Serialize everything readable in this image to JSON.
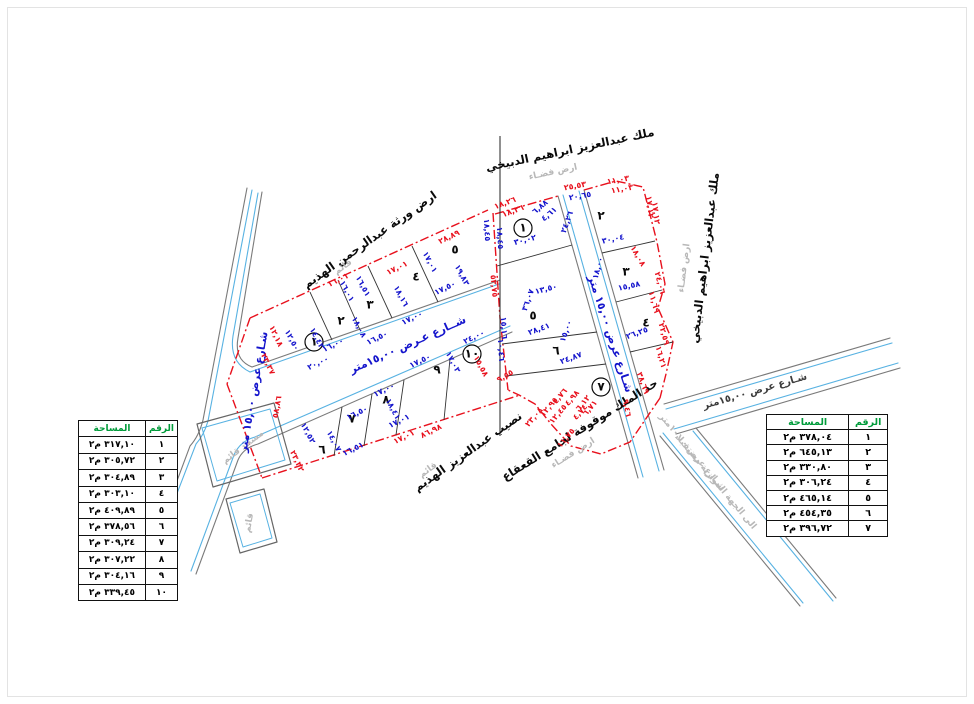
{
  "tables": {
    "left": {
      "headers": {
        "number": "الرقم",
        "area": "المساحة"
      },
      "unit": "م٢",
      "rows": [
        {
          "no": "١",
          "area": "٣١٧,١٠"
        },
        {
          "no": "٢",
          "area": "٣٠٥,٧٢"
        },
        {
          "no": "٣",
          "area": "٣٠٤,٨٩"
        },
        {
          "no": "٤",
          "area": "٣٠٣,١٠"
        },
        {
          "no": "٥",
          "area": "٤٠٩,٨٩"
        },
        {
          "no": "٦",
          "area": "٣٧٨,٥٦"
        },
        {
          "no": "٧",
          "area": "٣٠٩,٢٤"
        },
        {
          "no": "٨",
          "area": "٣٠٧,٢٢"
        },
        {
          "no": "٩",
          "area": "٣٠٤,١٦"
        },
        {
          "no": "١٠",
          "area": "٣٣٩,٤٥"
        }
      ]
    },
    "right": {
      "headers": {
        "number": "الرقم",
        "area": "المساحة"
      },
      "unit": "م٢",
      "rows": [
        {
          "no": "١",
          "area": "٣٧٨,٠٤"
        },
        {
          "no": "٢",
          "area": "٦٤٥,١٣"
        },
        {
          "no": "٣",
          "area": "٣٣٠,٨٠"
        },
        {
          "no": "٤",
          "area": "٣٠٦,٢٤"
        },
        {
          "no": "٥",
          "area": "٤٦٥,١٤"
        },
        {
          "no": "٦",
          "area": "٤٥٤,٣٥"
        },
        {
          "no": "٧",
          "area": "٣٩٦,٧٢"
        }
      ]
    }
  },
  "drawing": {
    "colors": {
      "dimension_red": "#e8111d",
      "dimension_blue": "#1414cc",
      "street_blue": "#58b2e2",
      "header_green": "#009b3a"
    },
    "labels": [
      {
        "t": "ملك عبدالعزيز ابراهيم الدبيخي",
        "x": 570,
        "y": 150,
        "r": -12,
        "c": "ow",
        "n": "owner-label-top"
      },
      {
        "t": "ارض فضـاء",
        "x": 553,
        "y": 172,
        "r": -12,
        "c": "mu",
        "n": "vacant-land-note"
      },
      {
        "t": "ملك عبدالعزيز ابراهيم الدبيخي",
        "x": 705,
        "y": 258,
        "r": -83,
        "c": "ow",
        "n": "owner-label-right"
      },
      {
        "t": "ارض فضـاء",
        "x": 684,
        "y": 268,
        "r": -83,
        "c": "mu",
        "n": "vacant-land-note"
      },
      {
        "t": "ارض ورثة عبدالرحمن الهذيم",
        "x": 370,
        "y": 240,
        "r": -35,
        "c": "ow",
        "n": "owner-label-top-left"
      },
      {
        "t": "قائم",
        "x": 343,
        "y": 267,
        "r": -35,
        "c": "mu",
        "n": "existing-note"
      },
      {
        "t": "نصيب عبدالعزيز الهذيم",
        "x": 468,
        "y": 452,
        "r": -35,
        "c": "ow",
        "n": "owner-label-bottom"
      },
      {
        "t": "قائم",
        "x": 428,
        "y": 470,
        "r": -35,
        "c": "mu",
        "n": "existing-note"
      },
      {
        "t": "حد الملك موقوفة لجامع القعقاع",
        "x": 580,
        "y": 430,
        "r": -32,
        "c": "ow",
        "n": "boundary-note-mosque-endowment"
      },
      {
        "t": "ارض فضـاء",
        "x": 573,
        "y": 453,
        "r": -32,
        "c": "mu",
        "n": "vacant-land-note"
      },
      {
        "t": "مسجد قائم",
        "x": 243,
        "y": 447,
        "r": -37,
        "c": "mu",
        "n": "existing-mosque-note"
      },
      {
        "t": "قائم",
        "x": 249,
        "y": 523,
        "r": -80,
        "c": "mu",
        "n": "existing-note"
      },
      {
        "t": "شــارع عـرض ١٥,٠٠متر",
        "x": 408,
        "y": 345,
        "r": -24,
        "c": "st",
        "n": "street-label-central"
      },
      {
        "t": "شـارع عرض ١٥,٠٠ متر",
        "x": 254,
        "y": 392,
        "r": -80,
        "c": "st",
        "n": "street-label-left"
      },
      {
        "t": "شـارع عرض ١٥,٠٠ متر",
        "x": 610,
        "y": 334,
        "r": 72,
        "c": "st",
        "n": "street-label-right-block"
      },
      {
        "t": "شـارع عرض ١٥,٠٠متر",
        "x": 755,
        "y": 391,
        "r": -16,
        "c": "sd",
        "n": "street-label-far-right"
      },
      {
        "t": "شـارع عرض ١٠,٠٠متر",
        "x": 692,
        "y": 452,
        "r": 50,
        "c": "mu",
        "n": "future-street-label"
      },
      {
        "t": "الى الجهة الموازية مستقبلا",
        "x": 716,
        "y": 482,
        "r": 50,
        "c": "mu",
        "n": "future-street-note"
      },
      {
        "t": "١",
        "x": 314,
        "y": 342,
        "r": 0,
        "c": "p",
        "circle": true,
        "n": "plot-number"
      },
      {
        "t": "٢",
        "x": 341,
        "y": 321,
        "r": 0,
        "c": "p",
        "n": "plot-number"
      },
      {
        "t": "٣",
        "x": 370,
        "y": 305,
        "r": 0,
        "c": "p",
        "n": "plot-number"
      },
      {
        "t": "٤",
        "x": 416,
        "y": 277,
        "r": 0,
        "c": "p",
        "n": "plot-number"
      },
      {
        "t": "٥",
        "x": 455,
        "y": 250,
        "r": 0,
        "c": "p",
        "n": "plot-number"
      },
      {
        "t": "٦",
        "x": 322,
        "y": 450,
        "r": 0,
        "c": "p",
        "n": "plot-number"
      },
      {
        "t": "٧",
        "x": 352,
        "y": 419,
        "r": 0,
        "c": "p",
        "n": "plot-number"
      },
      {
        "t": "٨",
        "x": 386,
        "y": 400,
        "r": 0,
        "c": "p",
        "n": "plot-number"
      },
      {
        "t": "٩",
        "x": 437,
        "y": 370,
        "r": 0,
        "c": "p",
        "n": "plot-number"
      },
      {
        "t": "١٠",
        "x": 472,
        "y": 354,
        "r": 0,
        "c": "p",
        "circle": true,
        "n": "plot-number"
      },
      {
        "t": "١",
        "x": 523,
        "y": 228,
        "r": 0,
        "c": "p",
        "circle": true,
        "n": "plot-number"
      },
      {
        "t": "٢",
        "x": 601,
        "y": 216,
        "r": 0,
        "c": "p",
        "n": "plot-number"
      },
      {
        "t": "٣",
        "x": 626,
        "y": 272,
        "r": 0,
        "c": "p",
        "n": "plot-number"
      },
      {
        "t": "٤",
        "x": 646,
        "y": 323,
        "r": 0,
        "c": "p",
        "n": "plot-number"
      },
      {
        "t": "٥",
        "x": 533,
        "y": 316,
        "r": 0,
        "c": "p",
        "n": "plot-number"
      },
      {
        "t": "٦",
        "x": 556,
        "y": 351,
        "r": 0,
        "c": "p",
        "n": "plot-number"
      },
      {
        "t": "٧",
        "x": 601,
        "y": 387,
        "r": 0,
        "c": "p",
        "circle": true,
        "n": "plot-number"
      },
      {
        "t": "١٤,٤٣",
        "x": 317,
        "y": 338,
        "r": 62,
        "c": "b"
      },
      {
        "t": "١٦,٠٠",
        "x": 333,
        "y": 345,
        "r": -26,
        "c": "b"
      },
      {
        "t": "١٦,٠١",
        "x": 347,
        "y": 291,
        "r": 62,
        "c": "b"
      },
      {
        "t": "١٨,٠٨",
        "x": 359,
        "y": 327,
        "r": 62,
        "c": "b"
      },
      {
        "t": "١٦,٥٠",
        "x": 377,
        "y": 338,
        "r": -26,
        "c": "b"
      },
      {
        "t": "١٦,٥١",
        "x": 363,
        "y": 286,
        "r": 62,
        "c": "b"
      },
      {
        "t": "١٨,١٦",
        "x": 401,
        "y": 296,
        "r": 62,
        "c": "b"
      },
      {
        "t": "١٧,٠٠",
        "x": 412,
        "y": 318,
        "r": -26,
        "c": "b"
      },
      {
        "t": "١٧,٠١",
        "x": 430,
        "y": 262,
        "r": 62,
        "c": "b"
      },
      {
        "t": "١٧,٥٠",
        "x": 445,
        "y": 288,
        "r": -26,
        "c": "b"
      },
      {
        "t": "١٩,٨٣",
        "x": 462,
        "y": 275,
        "r": 62,
        "c": "b"
      },
      {
        "t": "٢٠,٠٠",
        "x": 318,
        "y": 363,
        "r": -26,
        "c": "b"
      },
      {
        "t": "١٢,٥٠",
        "x": 292,
        "y": 340,
        "r": 62,
        "c": "b"
      },
      {
        "t": "١٢,٥٢",
        "x": 308,
        "y": 433,
        "r": 62,
        "c": "b"
      },
      {
        "t": "١٦,٥٠",
        "x": 357,
        "y": 413,
        "r": -26,
        "c": "b"
      },
      {
        "t": "١٤,٠٧",
        "x": 334,
        "y": 441,
        "r": 62,
        "c": "b"
      },
      {
        "t": "١٦,٥١",
        "x": 353,
        "y": 449,
        "r": -26,
        "c": "b"
      },
      {
        "t": "١٧,٠٠",
        "x": 384,
        "y": 390,
        "r": -26,
        "c": "b"
      },
      {
        "t": "١٨,٤١",
        "x": 393,
        "y": 409,
        "r": 62,
        "c": "b"
      },
      {
        "t": "١٧,٠١",
        "x": 399,
        "y": 421,
        "r": -26,
        "c": "b"
      },
      {
        "t": "١٧,٥٠",
        "x": 420,
        "y": 361,
        "r": -26,
        "c": "b"
      },
      {
        "t": "٢٤,٠٠",
        "x": 474,
        "y": 337,
        "r": -26,
        "c": "b"
      },
      {
        "t": "١٧,٠٣",
        "x": 453,
        "y": 362,
        "r": 62,
        "c": "b"
      },
      {
        "t": "٣٠,٠٢",
        "x": 525,
        "y": 240,
        "r": -14,
        "c": "b"
      },
      {
        "t": "١٨,٤٥",
        "x": 487,
        "y": 230,
        "r": 87,
        "c": "b"
      },
      {
        "t": "١٨,٤٥",
        "x": 500,
        "y": 238,
        "r": 87,
        "c": "b"
      },
      {
        "t": "٦,٨٨",
        "x": 540,
        "y": 207,
        "r": -40,
        "c": "b"
      },
      {
        "t": "٤,٦١",
        "x": 549,
        "y": 214,
        "r": -40,
        "c": "b"
      },
      {
        "t": "٢٤,٢٦",
        "x": 567,
        "y": 222,
        "r": -70,
        "c": "b"
      },
      {
        "t": "٢٠,٦٥",
        "x": 580,
        "y": 196,
        "r": -10,
        "c": "b"
      },
      {
        "t": "٣٠,٠٤",
        "x": 613,
        "y": 239,
        "r": -12,
        "c": "b"
      },
      {
        "t": "١٨,٠٠",
        "x": 598,
        "y": 268,
        "r": -75,
        "c": "b"
      },
      {
        "t": "١٥,٥٨",
        "x": 629,
        "y": 286,
        "r": -12,
        "c": "b"
      },
      {
        "t": "٢٦,٢٥",
        "x": 637,
        "y": 333,
        "r": -20,
        "c": "b"
      },
      {
        "t": "١٣,٥٠",
        "x": 546,
        "y": 289,
        "r": -14,
        "c": "b"
      },
      {
        "t": "٣٦,٠٧",
        "x": 528,
        "y": 300,
        "r": -70,
        "c": "b"
      },
      {
        "t": "١٥,١٦",
        "x": 504,
        "y": 328,
        "r": 87,
        "c": "b"
      },
      {
        "t": "١٠,٤٦",
        "x": 501,
        "y": 350,
        "r": 87,
        "c": "b"
      },
      {
        "t": "٢٨,٤١",
        "x": 539,
        "y": 329,
        "r": -20,
        "c": "b"
      },
      {
        "t": "١٥,٠٠",
        "x": 566,
        "y": 331,
        "r": -70,
        "c": "b"
      },
      {
        "t": "٢٤,٨٧",
        "x": 571,
        "y": 358,
        "r": -20,
        "c": "b"
      },
      {
        "t": "١٦,٠١",
        "x": 338,
        "y": 280,
        "r": -26,
        "c": "r"
      },
      {
        "t": "١٧,٠١",
        "x": 397,
        "y": 268,
        "r": -26,
        "c": "r"
      },
      {
        "t": "٢٨,٨٩",
        "x": 449,
        "y": 237,
        "r": -26,
        "c": "r"
      },
      {
        "t": "١٢,١٨",
        "x": 276,
        "y": 336,
        "r": 65,
        "c": "r"
      },
      {
        "t": "٢٣,٣٧",
        "x": 268,
        "y": 364,
        "r": 65,
        "c": "r"
      },
      {
        "t": "٥٨,٨٦",
        "x": 277,
        "y": 407,
        "r": -80,
        "c": "r"
      },
      {
        "t": "٢٣,٣٢",
        "x": 297,
        "y": 461,
        "r": 65,
        "c": "r"
      },
      {
        "t": "٨٦,٩٨",
        "x": 431,
        "y": 431,
        "r": -26,
        "c": "r"
      },
      {
        "t": "١٧,٠١",
        "x": 404,
        "y": 437,
        "r": -26,
        "c": "r"
      },
      {
        "t": "١٥,٥٨",
        "x": 481,
        "y": 366,
        "r": 62,
        "c": "r"
      },
      {
        "t": "١٨,٢٦",
        "x": 505,
        "y": 203,
        "r": -20,
        "c": "r"
      },
      {
        "t": "١٨,٢٦",
        "x": 513,
        "y": 211,
        "r": -20,
        "c": "r"
      },
      {
        "t": "٢٥,٥٣",
        "x": 575,
        "y": 186,
        "r": -10,
        "c": "r"
      },
      {
        "t": "١١,٠٣",
        "x": 618,
        "y": 180,
        "r": -10,
        "c": "r"
      },
      {
        "t": "١١,٠٣",
        "x": 622,
        "y": 189,
        "r": -10,
        "c": "r"
      },
      {
        "t": "١٧,١٢",
        "x": 650,
        "y": 207,
        "r": 83,
        "c": "r"
      },
      {
        "t": "١٧,١٢",
        "x": 656,
        "y": 213,
        "r": 83,
        "c": "r"
      },
      {
        "t": "١٨,٠٨",
        "x": 638,
        "y": 256,
        "r": 60,
        "c": "r"
      },
      {
        "t": "٢٤,٠٦",
        "x": 660,
        "y": 283,
        "r": 75,
        "c": "r"
      },
      {
        "t": "١١,٦٩",
        "x": 654,
        "y": 302,
        "r": 75,
        "c": "r"
      },
      {
        "t": "٢٢,٥٩",
        "x": 664,
        "y": 334,
        "r": 75,
        "c": "r"
      },
      {
        "t": "١٦,٢١",
        "x": 661,
        "y": 357,
        "r": 75,
        "c": "r"
      },
      {
        "t": "٣٨,٦٩",
        "x": 643,
        "y": 383,
        "r": 70,
        "c": "r"
      },
      {
        "t": "٥٣,٧٥",
        "x": 494,
        "y": 286,
        "r": 85,
        "c": "r"
      },
      {
        "t": "٩,٥٥",
        "x": 505,
        "y": 376,
        "r": -30,
        "c": "r"
      },
      {
        "t": "٢٣,٠٨",
        "x": 534,
        "y": 417,
        "r": -50,
        "c": "r"
      },
      {
        "t": "١٢,٩٥",
        "x": 549,
        "y": 407,
        "r": -50,
        "c": "r"
      },
      {
        "t": "١٢,٤٥",
        "x": 558,
        "y": 414,
        "r": -50,
        "c": "r"
      },
      {
        "t": "١١,٧٥",
        "x": 566,
        "y": 438,
        "r": -50,
        "c": "r"
      },
      {
        "t": "٤,٩٨",
        "x": 572,
        "y": 398,
        "r": -50,
        "c": "r"
      },
      {
        "t": "٤,٧٦",
        "x": 560,
        "y": 396,
        "r": -50,
        "c": "r"
      },
      {
        "t": "٦,١٢",
        "x": 583,
        "y": 403,
        "r": -50,
        "c": "r"
      },
      {
        "t": "٦,٧١",
        "x": 590,
        "y": 408,
        "r": -50,
        "c": "r"
      },
      {
        "t": "٤,٧٤",
        "x": 580,
        "y": 412,
        "r": -50,
        "c": "r"
      },
      {
        "t": "٩,٤٦",
        "x": 627,
        "y": 408,
        "r": 80,
        "c": "r"
      }
    ]
  }
}
